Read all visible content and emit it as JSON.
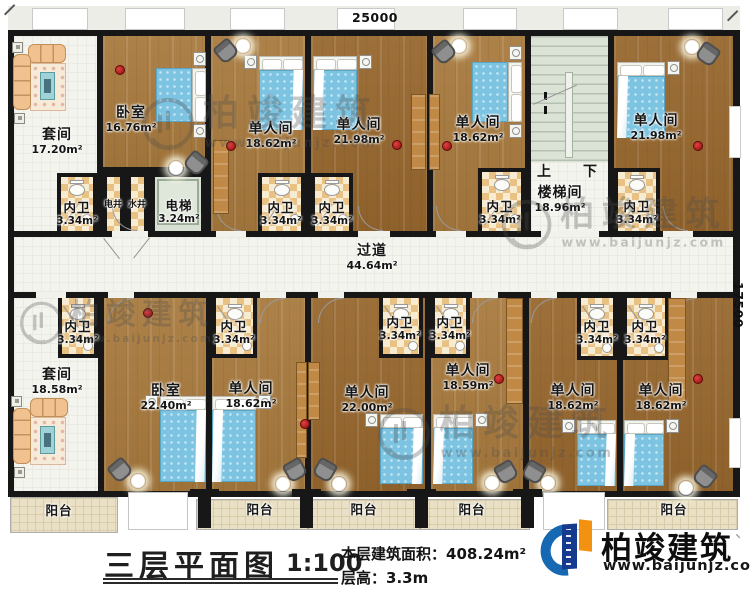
{
  "dimensions": {
    "top": "25000",
    "right": "17500"
  },
  "watermark": {
    "brand": "柏竣建筑",
    "url": "www.baijunjz.com"
  },
  "stair": {
    "up": "上",
    "down": "下"
  },
  "title_block": {
    "title": "三层平面图",
    "scale": "1:100",
    "area_label": "本层建筑面积：",
    "area_value": "408.24m²",
    "floor_height_label": "层高：",
    "floor_height_value": "3.3m"
  },
  "brand": {
    "name": "柏竣建筑",
    "url": "www.baijunjz.com",
    "tick": "、"
  },
  "rooms": [
    {
      "name": "套间",
      "area": "17.20m²",
      "type": "white",
      "rect": [
        14,
        36,
        83,
        195
      ],
      "label": [
        57,
        128
      ]
    },
    {
      "name": "卧室",
      "area": "16.76m²",
      "type": "wood",
      "rect": [
        103,
        36,
        102,
        131
      ],
      "label": [
        131,
        106
      ]
    },
    {
      "name": "单人间",
      "area": "18.62m²",
      "type": "wood",
      "rect": [
        211,
        36,
        94,
        195
      ],
      "label": [
        271,
        122
      ]
    },
    {
      "name": "单人间",
      "area": "21.98m²",
      "type": "wood",
      "sh": 1,
      "rect": [
        311,
        36,
        116,
        195
      ],
      "label": [
        359,
        118
      ]
    },
    {
      "name": "单人间",
      "area": "18.62m²",
      "type": "wood",
      "rect": [
        433,
        36,
        92,
        195
      ],
      "label": [
        478,
        116
      ]
    },
    {
      "name": "楼梯间",
      "area": "18.96m²",
      "type": "white",
      "rect": [
        531,
        36,
        77,
        195
      ],
      "label": [
        560,
        186
      ]
    },
    {
      "name": "单人间",
      "area": "21.98m²",
      "type": "wood",
      "sh": 1,
      "rect": [
        614,
        36,
        119,
        195
      ],
      "label": [
        656,
        114
      ]
    },
    {
      "name": "过道",
      "area": "44.64m²",
      "type": "corr",
      "rect": [
        14,
        237,
        719,
        55
      ],
      "label": [
        372,
        244
      ]
    },
    {
      "name": "套间",
      "area": "18.58m²",
      "type": "white",
      "rect": [
        14,
        298,
        84,
        193
      ],
      "label": [
        57,
        368
      ]
    },
    {
      "name": "卧室",
      "area": "22.40m²",
      "type": "wood",
      "rect": [
        104,
        298,
        102,
        193
      ],
      "label": [
        166,
        384
      ]
    },
    {
      "name": "单人间",
      "area": "18.62m²",
      "type": "wood",
      "rect": [
        212,
        298,
        93,
        193
      ],
      "label": [
        251,
        382
      ]
    },
    {
      "name": "单人间",
      "area": "22.00m²",
      "type": "wood",
      "sh": 1,
      "rect": [
        311,
        298,
        114,
        193
      ],
      "label": [
        367,
        386
      ]
    },
    {
      "name": "单人间",
      "area": "18.59m²",
      "type": "wood",
      "rect": [
        431,
        298,
        92,
        193
      ],
      "label": [
        468,
        364
      ]
    },
    {
      "name": "单人间",
      "area": "18.62m²",
      "type": "wood",
      "sh": 1,
      "rect": [
        529,
        298,
        88,
        193
      ],
      "label": [
        573,
        384
      ]
    },
    {
      "name": "单人间",
      "area": "18.62m²",
      "type": "wood",
      "sh": 1,
      "rect": [
        623,
        298,
        110,
        193
      ],
      "label": [
        661,
        384
      ]
    },
    {
      "name": "阳台",
      "type": "balcony",
      "rect": [
        10,
        497,
        108,
        36
      ],
      "label": [
        59,
        504
      ],
      "small": 1
    },
    {
      "name": "阳台",
      "type": "balcony",
      "rect": [
        196,
        499,
        112,
        31
      ],
      "label": [
        260,
        503
      ],
      "small": 1
    },
    {
      "name": "阳台",
      "type": "balcony",
      "rect": [
        308,
        499,
        112,
        31
      ],
      "label": [
        364,
        503
      ],
      "small": 1
    },
    {
      "name": "阳台",
      "type": "balcony",
      "rect": [
        420,
        499,
        110,
        31
      ],
      "label": [
        472,
        503
      ],
      "small": 1
    },
    {
      "name": "阳台",
      "type": "balcony",
      "rect": [
        607,
        499,
        131,
        31
      ],
      "label": [
        674,
        503
      ],
      "small": 1
    }
  ],
  "cells": [
    {
      "name": "内卫",
      "area": "3.34m²",
      "rect": [
        57,
        173,
        40,
        58
      ],
      "label": [
        77,
        201
      ],
      "wc": 1,
      "bd": "t"
    },
    {
      "name": "电井",
      "rect": [
        103,
        173,
        21,
        58
      ],
      "label": [
        113,
        201
      ],
      "bd": "t",
      "tiny": 1
    },
    {
      "name": "水井",
      "rect": [
        127,
        173,
        21,
        58
      ],
      "label": [
        137,
        201
      ],
      "bd": "t",
      "tiny": 1
    },
    {
      "name": "电梯",
      "area": "3.24m²",
      "type": "elev",
      "rect": [
        151,
        173,
        54,
        58
      ],
      "label": [
        179,
        199
      ],
      "bd": "t"
    },
    {
      "name": "内卫",
      "area": "3.34m²",
      "rect": [
        258,
        173,
        47,
        58
      ],
      "label": [
        281,
        201
      ],
      "wc": 1,
      "bd": "t"
    },
    {
      "name": "内卫",
      "area": "3.34m²",
      "rect": [
        311,
        173,
        42,
        58
      ],
      "label": [
        332,
        201
      ],
      "wc": 1,
      "bd": "t"
    },
    {
      "name": "内卫",
      "area": "3.34m²",
      "rect": [
        478,
        168,
        47,
        63
      ],
      "label": [
        500,
        200
      ],
      "wc": 1,
      "bd": "t"
    },
    {
      "name": "内卫",
      "area": "3.34m²",
      "rect": [
        614,
        168,
        46,
        63
      ],
      "label": [
        637,
        200
      ],
      "wc": 1,
      "bd": "t"
    },
    {
      "name": "内卫",
      "area": "3.34m²",
      "rect": [
        58,
        298,
        40,
        60
      ],
      "label": [
        78,
        320
      ],
      "wc": 1,
      "bd": "b"
    },
    {
      "name": "内卫",
      "area": "3.34m²",
      "rect": [
        212,
        298,
        45,
        60
      ],
      "label": [
        234,
        320
      ],
      "wc": 1,
      "bd": "b"
    },
    {
      "name": "内卫",
      "area": "3.34m²",
      "rect": [
        379,
        298,
        44,
        60
      ],
      "label": [
        400,
        316
      ],
      "wc": 1,
      "bd": "b"
    },
    {
      "name": "内卫",
      "area": "3.34m²",
      "rect": [
        431,
        298,
        39,
        60
      ],
      "label": [
        450,
        316
      ],
      "wc": 1,
      "bd": "b"
    },
    {
      "name": "内卫",
      "area": "3.34m²",
      "rect": [
        577,
        298,
        40,
        62
      ],
      "label": [
        597,
        320
      ],
      "wc": 1,
      "bd": "b"
    },
    {
      "name": "内卫",
      "area": "3.34m²",
      "rect": [
        623,
        298,
        46,
        62
      ],
      "label": [
        645,
        320
      ],
      "wc": 1,
      "bd": "b"
    }
  ],
  "layout": {
    "eave": [
      8,
      6,
      732,
      24
    ],
    "bands": [
      [
        8,
        30,
        732,
        207
      ],
      [
        8,
        292,
        732,
        205
      ]
    ],
    "wall_stubs": [
      [
        8,
        237,
        6,
        55
      ],
      [
        733,
        237,
        7,
        55
      ]
    ],
    "windows_top": [
      [
        32,
        56
      ],
      [
        125,
        60
      ],
      [
        230,
        55
      ],
      [
        337,
        58
      ],
      [
        463,
        54
      ],
      [
        563,
        55
      ],
      [
        668,
        55
      ]
    ],
    "side_windows": [
      [
        729,
        106,
        12,
        52
      ],
      [
        729,
        418,
        12,
        50
      ]
    ],
    "openings": [
      [
        128,
        492,
        60,
        38
      ],
      [
        543,
        492,
        62,
        38
      ]
    ],
    "columns": [
      198,
      300,
      415,
      521
    ],
    "door_gaps_top": [
      [
        112,
        36
      ],
      [
        216,
        30
      ],
      [
        358,
        32
      ],
      [
        436,
        30
      ],
      [
        541,
        58
      ],
      [
        663,
        30
      ]
    ],
    "arcs_top": [
      112,
      216,
      358,
      436,
      663
    ],
    "door_gaps_bottom": [
      [
        36,
        30
      ],
      [
        108,
        26
      ],
      [
        260,
        26
      ],
      [
        318,
        26
      ],
      [
        472,
        26
      ],
      [
        531,
        26
      ],
      [
        671,
        26
      ]
    ],
    "arcs_bottom": [
      108,
      260,
      318,
      472,
      531,
      671
    ],
    "stair": {
      "pad": [
        531,
        36,
        77,
        126
      ],
      "rail": [
        565,
        72,
        8,
        86
      ],
      "ticks": [
        [
          544,
          92,
          3,
          8
        ],
        [
          544,
          106,
          3,
          8
        ]
      ],
      "up_pos": [
        537,
        161
      ],
      "down_pos": [
        583,
        161
      ]
    },
    "elev_inner": [
      157,
      179,
      42,
      46
    ],
    "lines": [
      {
        "p": [
          104,
          238
        ],
        "len": 26,
        "rot": 52
      },
      {
        "p": [
          150,
          238
        ],
        "len": 26,
        "rot": 128
      },
      {
        "p": [
          533,
          104
        ],
        "len": 48,
        "rot": -24
      }
    ],
    "beds": [
      {
        "r": [
          156,
          68,
          50,
          54
        ],
        "o": "e",
        "st": "tb"
      },
      {
        "r": [
          259,
          56,
          44,
          74
        ],
        "o": "n",
        "st": "l",
        "f": "r"
      },
      {
        "r": [
          313,
          56,
          44,
          74
        ],
        "o": "n",
        "st": "r",
        "f": "l"
      },
      {
        "r": [
          472,
          62,
          50,
          60
        ],
        "o": "e",
        "st": "tb"
      },
      {
        "r": [
          617,
          62,
          48,
          76
        ],
        "o": "n",
        "st": "r",
        "f": "l"
      },
      {
        "r": [
          160,
          396,
          46,
          86
        ],
        "o": "n",
        "st": "l",
        "f": "r"
      },
      {
        "r": [
          212,
          396,
          44,
          86
        ],
        "o": "n",
        "st": "r",
        "f": "l"
      },
      {
        "r": [
          380,
          414,
          43,
          70
        ],
        "o": "n",
        "st": "l",
        "f": "r"
      },
      {
        "r": [
          433,
          414,
          40,
          70
        ],
        "o": "n",
        "st": "r",
        "f": "l"
      },
      {
        "r": [
          577,
          420,
          39,
          66
        ],
        "o": "n",
        "st": "l",
        "f": "r"
      },
      {
        "r": [
          624,
          420,
          40,
          66
        ],
        "o": "n",
        "st": "r",
        "f": "l"
      }
    ],
    "sofas": [
      {
        "top": [
          28,
          44,
          38,
          19
        ],
        "left": [
          13,
          54,
          18,
          56
        ],
        "rug": [
          30,
          63,
          36,
          48
        ],
        "table": [
          40,
          72,
          15,
          28
        ],
        "sq": [
          [
            12,
            42
          ],
          [
            14,
            113
          ]
        ]
      },
      {
        "top": [
          30,
          398,
          38,
          19
        ],
        "left": [
          13,
          408,
          18,
          56
        ],
        "rug": [
          30,
          417,
          36,
          48
        ],
        "table": [
          40,
          426,
          15,
          28
        ],
        "sq": [
          [
            11,
            396
          ],
          [
            14,
            467
          ]
        ]
      }
    ],
    "chairs": [
      [
        226,
        51,
        -40
      ],
      [
        196,
        163,
        40
      ],
      [
        444,
        52,
        -40
      ],
      [
        708,
        54,
        35
      ],
      [
        120,
        470,
        -40
      ],
      [
        295,
        470,
        -30
      ],
      [
        325,
        470,
        30
      ],
      [
        506,
        472,
        -30
      ],
      [
        534,
        472,
        30
      ],
      [
        705,
        477,
        38
      ]
    ],
    "glows": [
      [
        243,
        46
      ],
      [
        176,
        168
      ],
      [
        459,
        46
      ],
      [
        692,
        47
      ],
      [
        138,
        481
      ],
      [
        283,
        484
      ],
      [
        339,
        484
      ],
      [
        492,
        483
      ],
      [
        548,
        483
      ],
      [
        686,
        488
      ]
    ],
    "dots": [
      [
        120,
        70
      ],
      [
        231,
        146
      ],
      [
        397,
        145
      ],
      [
        447,
        146
      ],
      [
        698,
        146
      ],
      [
        148,
        313
      ],
      [
        305,
        424
      ],
      [
        499,
        379
      ],
      [
        698,
        379
      ]
    ],
    "closets": [
      [
        213,
        140,
        16,
        74
      ],
      [
        411,
        94,
        15,
        76
      ],
      [
        429,
        94,
        11,
        76
      ],
      [
        296,
        362,
        11,
        96
      ],
      [
        308,
        362,
        12,
        58
      ],
      [
        506,
        298,
        17,
        106
      ],
      [
        668,
        298,
        18,
        106
      ]
    ],
    "watermarks": [
      {
        "p": [
          142,
          96
        ],
        "s": 1
      },
      {
        "p": [
          502,
          198
        ],
        "s": 0.95
      },
      {
        "p": [
          20,
          300
        ],
        "s": 0.82
      },
      {
        "p": [
          378,
          406
        ],
        "s": 1
      }
    ],
    "corner_ticks": [
      [
        4,
        14,
        -45
      ],
      [
        727,
        20,
        -45
      ]
    ],
    "underlines": [
      [
        578,
        2
      ],
      [
        582,
        1.5
      ]
    ]
  }
}
